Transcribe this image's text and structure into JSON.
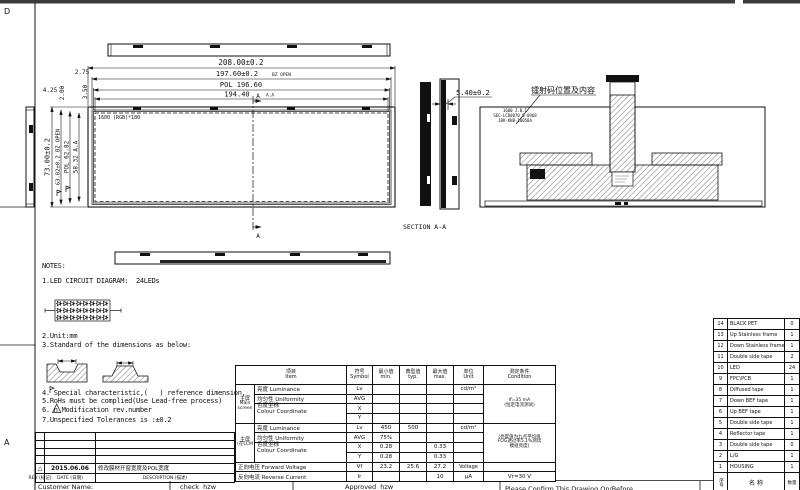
{
  "frame": {
    "zone_d": "D",
    "zone_a": "A"
  },
  "dims": {
    "outer_w": "208.00±0.2",
    "bz_w": "197.60±0.2",
    "bz_w_suffix": "BZ OPEN",
    "pol_w": "POL 196.60",
    "aa_w": "194.40",
    "aa_w_suffix": "A.A",
    "off_275": "2.75",
    "off_350": "3.50",
    "off_425": "4.25",
    "off_200": "2.00",
    "outer_h": "73.00±0.2",
    "bz_h": "63.82±0.2 BZ OPEN",
    "pol_h": "POL 62.82",
    "aa_h": "58.32 A.A",
    "thickness": "5.40±0.2",
    "resolution": "1600 (RGB)*180",
    "section_label": "SECTION A-A",
    "section_mark": "A"
  },
  "laser": {
    "label": "镭射码位置及内容",
    "code_line1": "1600 J.B.I",
    "code_line2": "SEC-LCD0070 S-0968",
    "code_line3": "JBK-KNB-10058A"
  },
  "notes": {
    "title": "NOTES:",
    "n1": "1.LED CIRCUIT DIAGRAM:  24LEDs",
    "n2": "2.Unit:mm",
    "n3": "3.Standard of the dimensions as below:",
    "n4": "4. Special characteristic,(   ) reference dimension,",
    "n5": "5.RoHs must be complied(Use Lead-free process)",
    "n6": "6. n Modification rev.number",
    "n7": "7.Unspecified Tolerances is :±0.2"
  },
  "revision": {
    "marker": "△",
    "date": "2015.06.06",
    "description": "修改膜材开窗宽度及POL宽度",
    "rev_header": "REV (标记)",
    "date_header": "DATE (日期)",
    "desc_header": "DESCRIPTION (描述)"
  },
  "etable": {
    "hdr": {
      "item_cn": "项目",
      "item_en": "Item",
      "sym_cn": "符号",
      "sym_en": "Symbol",
      "min_cn": "最小值",
      "min_en": "min.",
      "typ_cn": "典型值",
      "typ_en": "typ.",
      "max_cn": "最大值",
      "max_en": "max.",
      "unit_cn": "单位",
      "unit_en": "Unit",
      "cond_cn": "测定条件",
      "cond_en": "Condition"
    },
    "g1": {
      "cn": "主屏",
      "en": "Main screen",
      "cond1": "If=35 mA",
      "cond2": "(恒定电流测试)"
    },
    "g2": {
      "cn": "主屏",
      "en": "(在LCM",
      "cond1": "(亮度值为九点平均值",
      "cond2": "FOG透过率5.1%测试",
      "cond3": "模组亮度)"
    },
    "lum": "亮度  Luminance",
    "uni": "均匀性  Uniformity",
    "chro1": "色度坐标",
    "chro2": "Colour Coordinate",
    "lv": "Lv",
    "avg": "AVG",
    "x": "X",
    "y": "Y",
    "cdm2": "cd/m²",
    "g2_lv_min": "450",
    "g2_lv_typ": "500",
    "g2_avg_min": "75%",
    "g2_x_min": "0.28",
    "g2_x_max": "0.33",
    "g2_y_min": "0.28",
    "g2_y_max": "0.33",
    "fv_label": "正向电压  Forward Voltage",
    "fv_sym": "Vf",
    "fv_min": "23.2",
    "fv_typ": "25.6",
    "fv_max": "27.2",
    "fv_unit": "Voltage",
    "rc_label": "反向电流  Reverse Current",
    "rc_sym": "Ir",
    "rc_max": "10",
    "rc_unit": "μA",
    "rc_cond": "Vr=30  V"
  },
  "parts": {
    "col_no": "序号",
    "col_name": "名 称",
    "col_qty": "数量",
    "rows": [
      {
        "no": "14",
        "name": "BLACK PET",
        "qty": "0"
      },
      {
        "no": "13",
        "name": "Up Stainless frame",
        "qty": "1"
      },
      {
        "no": "12",
        "name": "Down Stainless frame",
        "qty": "1"
      },
      {
        "no": "11",
        "name": "Double side tape",
        "qty": "2"
      },
      {
        "no": "10",
        "name": "LED",
        "qty": "24"
      },
      {
        "no": "9",
        "name": "FPC\\PCB",
        "qty": "1"
      },
      {
        "no": "8",
        "name": "Diffused tape",
        "qty": "1"
      },
      {
        "no": "7",
        "name": "Down BEF tape",
        "qty": "1"
      },
      {
        "no": "6",
        "name": "Up BEF tape",
        "qty": "1"
      },
      {
        "no": "5",
        "name": "Double side tape",
        "qty": "1"
      },
      {
        "no": "4",
        "name": "Reflector tape",
        "qty": "1"
      },
      {
        "no": "3",
        "name": "Double side tape",
        "qty": "0"
      },
      {
        "no": "2",
        "name": "L/G",
        "qty": "1"
      },
      {
        "no": "1",
        "name": "HOUSING",
        "qty": "1"
      }
    ]
  },
  "footer": {
    "customer": "Customer Name:",
    "check": "check  hzw",
    "approved": "Approved  hzw",
    "confirm": "Please Confirm This Drawing On/Before"
  }
}
